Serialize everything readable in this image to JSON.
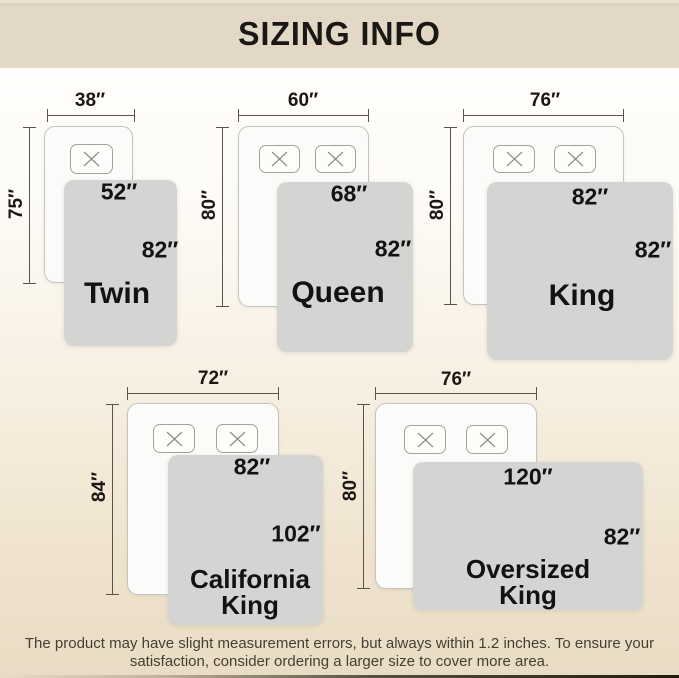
{
  "header": {
    "title": "SIZING INFO"
  },
  "sizes": [
    {
      "name": "Twin",
      "pillow_count": 1,
      "mattress": {
        "width_label": "38″",
        "length_label": "75″"
      },
      "blanket": {
        "width_label": "52″",
        "length_label": "82″"
      }
    },
    {
      "name": "Queen",
      "pillow_count": 2,
      "mattress": {
        "width_label": "60″",
        "length_label": "80″"
      },
      "blanket": {
        "width_label": "68″",
        "length_label": "82″"
      }
    },
    {
      "name": "King",
      "pillow_count": 2,
      "mattress": {
        "width_label": "76″",
        "length_label": "80″"
      },
      "blanket": {
        "width_label": "82″",
        "length_label": "82″"
      }
    },
    {
      "name": "California King",
      "pillow_count": 2,
      "mattress": {
        "width_label": "72″",
        "length_label": "84″"
      },
      "blanket": {
        "width_label": "82″",
        "length_label": "102″"
      }
    },
    {
      "name": "Oversized King",
      "pillow_count": 2,
      "mattress": {
        "width_label": "76″",
        "length_label": "80″"
      },
      "blanket": {
        "width_label": "120″",
        "length_label": "82″"
      }
    }
  ],
  "footer": {
    "note_line1": "The product may have slight measurement errors, but always within 1.2 inches. To ensure your",
    "note_line2": "satisfaction, consider ordering a larger size to cover more area."
  },
  "colors": {
    "header_bg": "#e3d7c6",
    "blanket": "#d4d4d3",
    "mattress": "#fbfbf9",
    "text": "#1b1813",
    "dim_line": "#57534d",
    "footer_text": "#453e33"
  }
}
